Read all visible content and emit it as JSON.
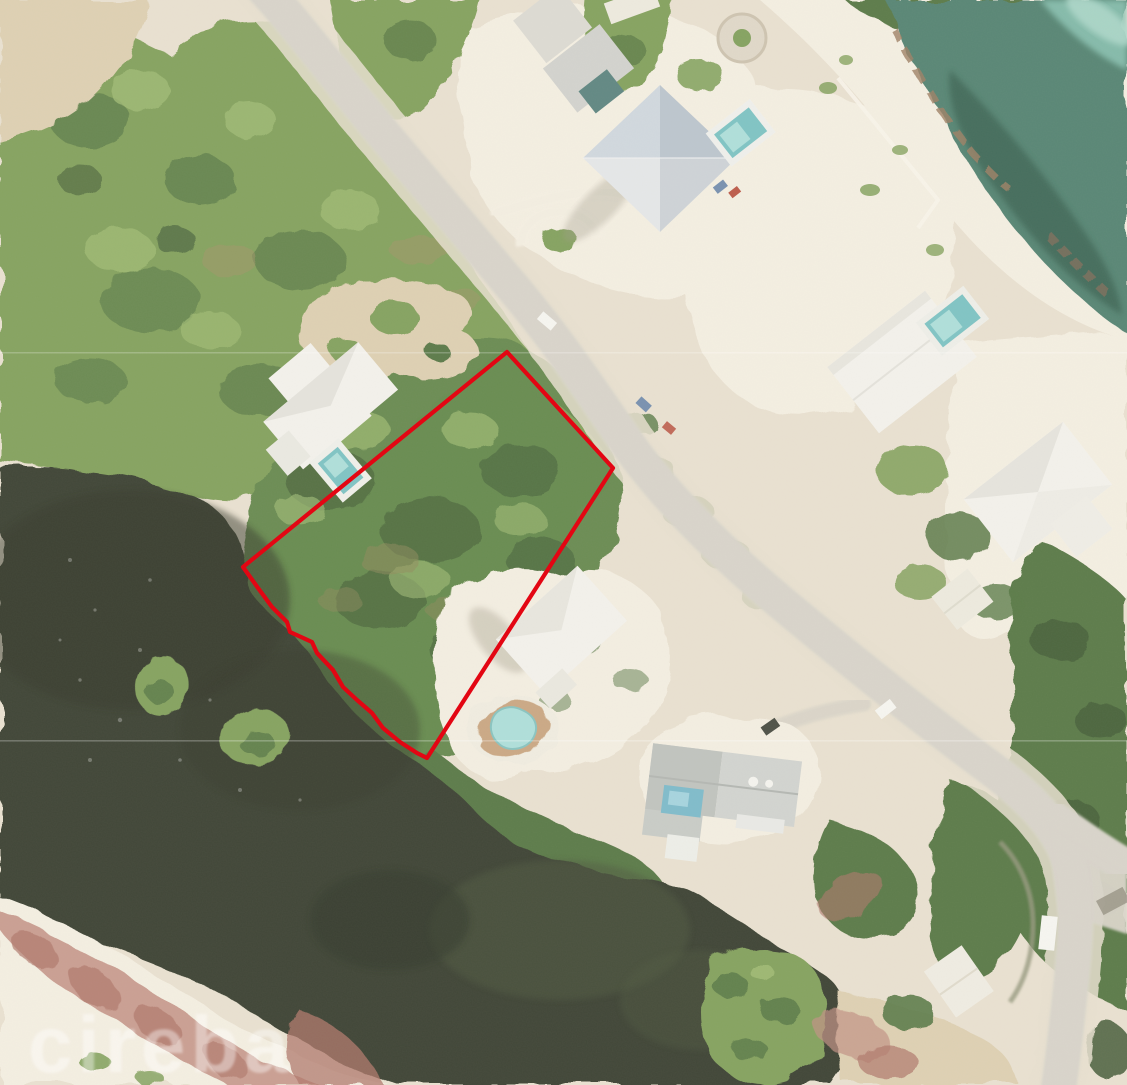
{
  "image": {
    "kind": "aerial photograph",
    "width": 1127,
    "height": 1085,
    "description": "Coastal aerial photo of a beachfront neighbourhood with a vacant treed parcel outlined in red between a road and a dark brackish pond"
  },
  "watermark": {
    "text": "cireba"
  },
  "parcel": {
    "boundary_points": "507,352 613,468 427,758 417,753 400,742 383,728 372,713 357,700 343,687 333,670 317,653 312,642 290,632 287,622 272,607 258,588 243,567",
    "stroke_width": "4.2"
  },
  "palette": {
    "sand_base": "#e7dfce",
    "sand_bright": "#f3eee1",
    "sand_tan": "#dbcdae",
    "road": "#d6d2c8",
    "road_shoulder": "#e6dfcd",
    "veg_light": "#97b56a",
    "veg_mid": "#7a9b53",
    "veg_dark": "#4d6f3b",
    "veg_deep": "#34502b",
    "parcel_green": "#5a8243",
    "dry_brush": "#9a8e5e",
    "pond_water": "#2d3625",
    "lagoon_light": "#414c31",
    "ocean_base": "#497c6b",
    "ocean_dark": "#2e5a4a",
    "ocean_light": "#7fbcab",
    "ocean_pale": "#aad8ca",
    "seaweed": "#96775a",
    "roof_white": "#f3f2ec",
    "roof_gray": "#c9ccc9",
    "roof_blue": "#c0cad3",
    "pool_teal": "#74c0c1",
    "pool_light": "#a8ddd9",
    "deck_tan": "#c6a27c",
    "pink_veg": "#bd897c",
    "pink_deep": "#a96d61",
    "boundary_red": "#e30613",
    "car_white": "#f6f6f2",
    "car_dark": "#3e4238",
    "car_blue": "#6c89ab",
    "car_red": "#b64e3c",
    "scanline": "rgba(255,255,255,0.5)",
    "watermark": "rgba(255,255,255,0.4)"
  },
  "features": [
    {
      "name": "ocean",
      "desc": "turquoise sea water, top-right corner"
    },
    {
      "name": "beach",
      "desc": "white sand shoreline with seaweed lines"
    },
    {
      "name": "coastal-road",
      "desc": "paved road running diagonally from top-left to bottom-right"
    },
    {
      "name": "outlined-parcel",
      "desc": "vacant densely vegetated lot outlined in red"
    },
    {
      "name": "pond",
      "desc": "dark brackish pond on the left"
    },
    {
      "name": "lagoon",
      "desc": "dark lagoon across the bottom"
    },
    {
      "name": "mangroves",
      "desc": "mangrove islands and shoreline clusters"
    },
    {
      "name": "houses",
      "desc": "white and grey roofed houses with swimming pools"
    },
    {
      "name": "dried-vegetation",
      "desc": "pink-red dried brush over sand, bottom-left"
    }
  ]
}
